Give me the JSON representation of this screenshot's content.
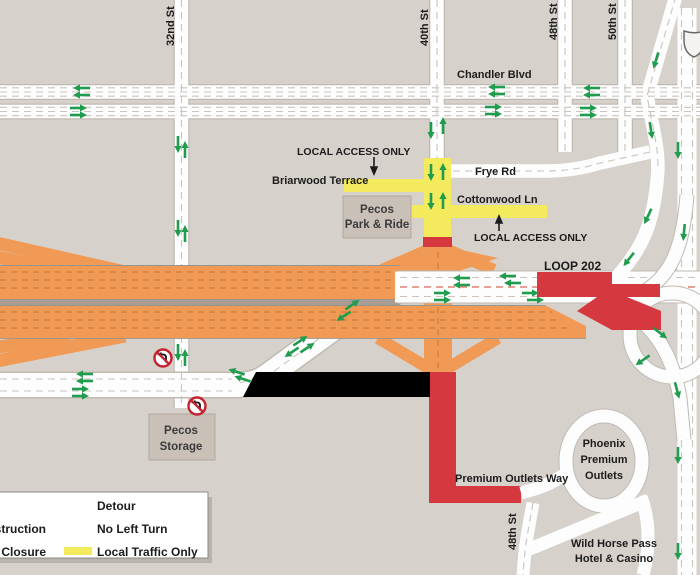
{
  "title": "Loop 202 construction detour map",
  "colors": {
    "background": "#d7d1cb",
    "road_white": "#fdfdfd",
    "construction_orange": "#f19a55",
    "closure_red": "#d63840",
    "local_traffic_yellow": "#f3ea5e",
    "detour_green": "#1f9c4d",
    "closed_black": "#000000",
    "box_grey": "#c9c0b7"
  },
  "labels": {
    "streets": {
      "s32": "32nd St",
      "s40": "40th St",
      "s48": "48th St",
      "s50": "50th St",
      "s48_bottom": "48th St",
      "chandler": "Chandler Blvd",
      "frye": "Frye Rd",
      "briarwood": "Briarwood Terrace",
      "cottonwood": "Cottonwood Ln",
      "loop202": "LOOP 202",
      "premium_outlets_way": "Premium Outlets Way"
    },
    "access_top": "LOCAL  ACCESS ONLY",
    "access_bottom": "LOCAL  ACCESS ONLY",
    "pecos_park_ride": {
      "line1": "Pecos",
      "line2": "Park & Ride"
    },
    "pecos_storage": {
      "line1": "Pecos",
      "line2": "Storage"
    },
    "phoenix_premium_outlets": {
      "line1": "Phoenix",
      "line2": "Premium",
      "line3": "Outlets"
    },
    "wild_horse_pass": {
      "line1": "Wild Horse Pass",
      "line2": "Hotel & Casino"
    }
  },
  "legend": {
    "col1_row2_partial": "struction",
    "col1_row3_partial": "Closure",
    "detour": "Detour",
    "no_left_turn": "No Left Turn",
    "local_traffic_only": "Local Traffic Only"
  },
  "map": {
    "detour_arrows": [
      {
        "x": 82,
        "y": 88,
        "a": 180
      },
      {
        "x": 82,
        "y": 95,
        "a": 180
      },
      {
        "x": 497,
        "y": 87,
        "a": 180
      },
      {
        "x": 497,
        "y": 94,
        "a": 180
      },
      {
        "x": 592,
        "y": 88,
        "a": 180
      },
      {
        "x": 592,
        "y": 95,
        "a": 180
      },
      {
        "x": 78,
        "y": 108,
        "a": 0
      },
      {
        "x": 78,
        "y": 115,
        "a": 0
      },
      {
        "x": 493,
        "y": 107,
        "a": 0
      },
      {
        "x": 493,
        "y": 114,
        "a": 0
      },
      {
        "x": 588,
        "y": 108,
        "a": 0
      },
      {
        "x": 588,
        "y": 115,
        "a": 0
      },
      {
        "x": 178,
        "y": 144,
        "a": 90
      },
      {
        "x": 185,
        "y": 150,
        "a": -90
      },
      {
        "x": 178,
        "y": 228,
        "a": 90
      },
      {
        "x": 185,
        "y": 234,
        "a": -90
      },
      {
        "x": 178,
        "y": 352,
        "a": 90
      },
      {
        "x": 185,
        "y": 358,
        "a": -90
      },
      {
        "x": 431,
        "y": 130,
        "a": 90
      },
      {
        "x": 443,
        "y": 126,
        "a": -90
      },
      {
        "x": 431,
        "y": 172,
        "a": 90
      },
      {
        "x": 443,
        "y": 172,
        "a": -90
      },
      {
        "x": 431,
        "y": 201,
        "a": 90
      },
      {
        "x": 443,
        "y": 201,
        "a": -90
      },
      {
        "x": 85,
        "y": 374,
        "a": 180
      },
      {
        "x": 85,
        "y": 381,
        "a": 180
      },
      {
        "x": 80,
        "y": 389,
        "a": 0
      },
      {
        "x": 80,
        "y": 396,
        "a": 0
      },
      {
        "x": 237,
        "y": 372,
        "a": 198
      },
      {
        "x": 243,
        "y": 379,
        "a": 198
      },
      {
        "x": 300,
        "y": 341,
        "a": -34
      },
      {
        "x": 307,
        "y": 348,
        "a": -34
      },
      {
        "x": 352,
        "y": 305,
        "a": -34
      },
      {
        "x": 292,
        "y": 352,
        "a": 146
      },
      {
        "x": 344,
        "y": 316,
        "a": 146
      },
      {
        "x": 462,
        "y": 278,
        "a": 180
      },
      {
        "x": 462,
        "y": 285,
        "a": 180
      },
      {
        "x": 508,
        "y": 276,
        "a": 180
      },
      {
        "x": 513,
        "y": 283,
        "a": 180
      },
      {
        "x": 442,
        "y": 293,
        "a": 0
      },
      {
        "x": 442,
        "y": 300,
        "a": 0
      },
      {
        "x": 530,
        "y": 293,
        "a": 0
      },
      {
        "x": 535,
        "y": 300,
        "a": 0
      },
      {
        "x": 648,
        "y": 216,
        "a": 115
      },
      {
        "x": 629,
        "y": 259,
        "a": 128
      },
      {
        "x": 684,
        "y": 232,
        "a": 95
      },
      {
        "x": 656,
        "y": 60,
        "a": 107
      },
      {
        "x": 651,
        "y": 130,
        "a": 81
      },
      {
        "x": 678,
        "y": 150,
        "a": 90
      },
      {
        "x": 678,
        "y": 455,
        "a": 90
      },
      {
        "x": 678,
        "y": 551,
        "a": 90
      },
      {
        "x": 660,
        "y": 333,
        "a": 38
      },
      {
        "x": 677,
        "y": 390,
        "a": 75
      },
      {
        "x": 643,
        "y": 360,
        "a": 145
      },
      {
        "x": 78,
        "y": 505,
        "a": 0,
        "s": 1.35
      }
    ],
    "no_left_turn_icons": [
      {
        "x": 163,
        "y": 358
      },
      {
        "x": 197,
        "y": 406
      },
      {
        "x": 80,
        "y": 528
      }
    ]
  }
}
